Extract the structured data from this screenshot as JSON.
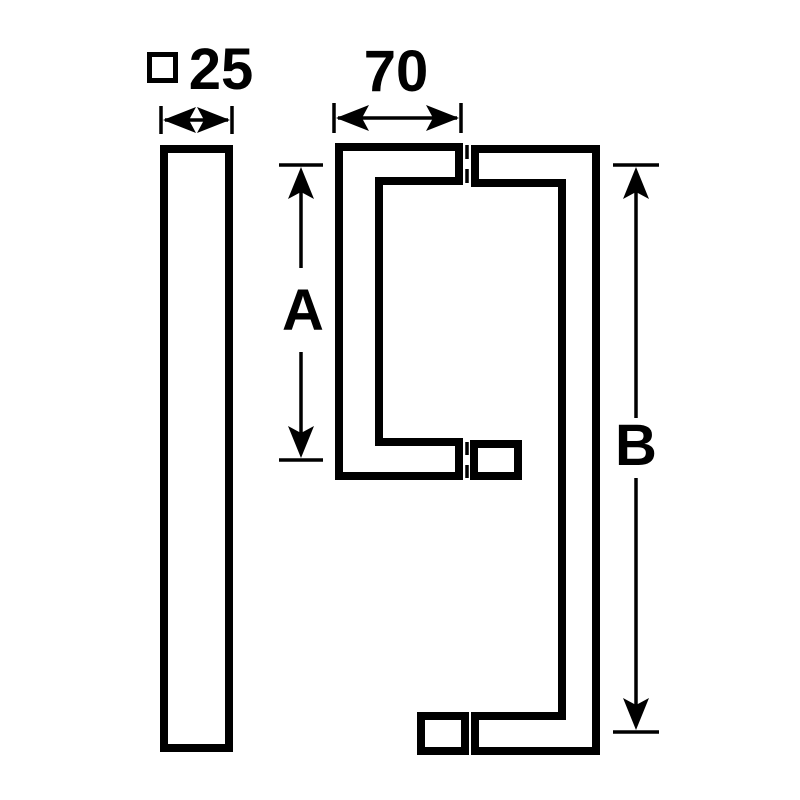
{
  "drawing": {
    "title": "pull-handle-technical-drawing",
    "colors": {
      "line": "#000000",
      "background": "#ffffff"
    },
    "labels": {
      "profile_symbol": "□",
      "profile_size": "25",
      "grip_width": "70",
      "centers_short": "A",
      "centers_tall": "B"
    },
    "icons": {
      "square_profile": "square-outline-icon"
    }
  }
}
